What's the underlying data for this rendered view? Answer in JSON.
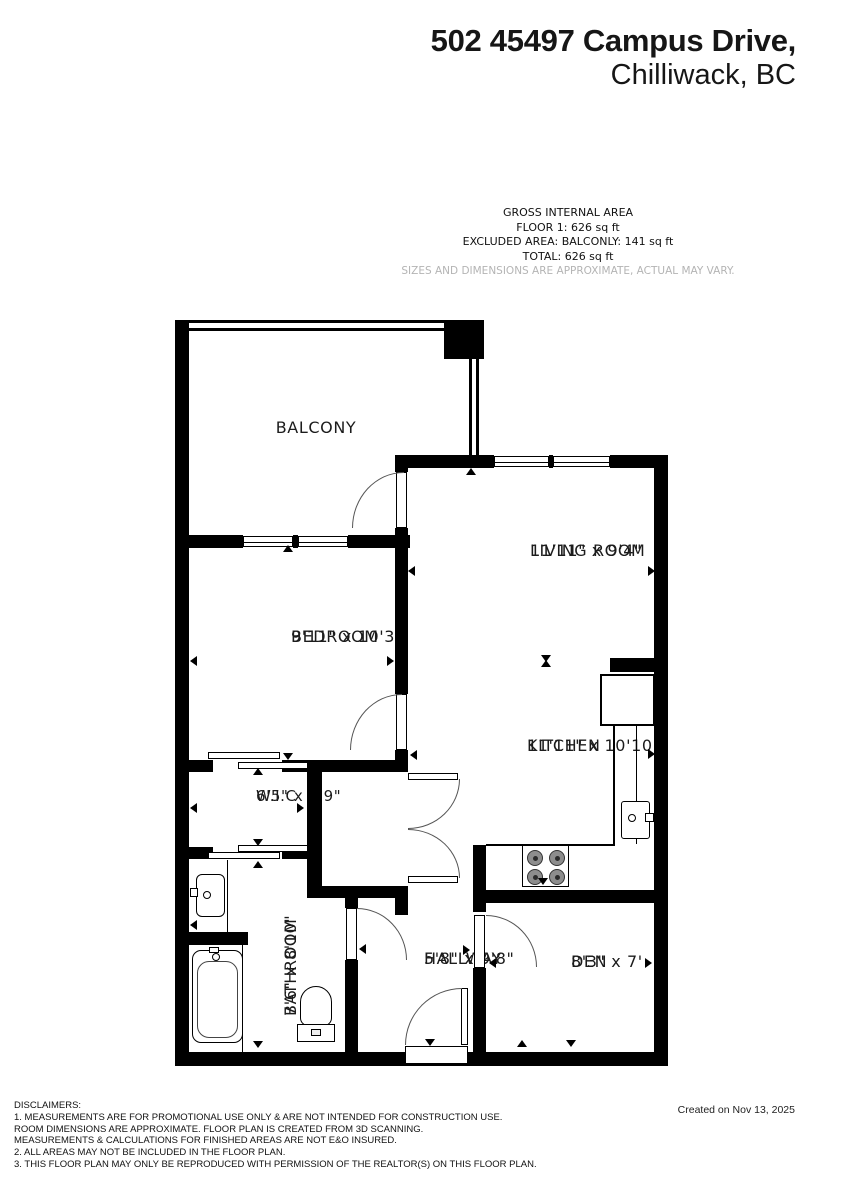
{
  "header": {
    "title_line1": "502 45497 Campus Drive,",
    "title_line2": "Chilliwack, BC"
  },
  "area_summary": {
    "line1": "GROSS INTERNAL AREA",
    "line2": "FLOOR 1: 626 sq ft",
    "line3": "EXCLUDED AREA: BALCONLY: 141 sq ft",
    "line4": "TOTAL: 626 sq ft",
    "note": "SIZES AND DIMENSIONS ARE APPROXIMATE, ACTUAL MAY VARY."
  },
  "rooms": {
    "balcony": {
      "name": "BALCONY",
      "dims": ""
    },
    "living": {
      "name": "LIVING ROOM",
      "dims": "11'11\" x 9'4\""
    },
    "bedroom": {
      "name": "BEDROOM",
      "dims": "9'11\" x 10'3\""
    },
    "kitchen": {
      "name": "KITCHEN",
      "dims": "11'11\" x 10'10\""
    },
    "wic": {
      "name": "W.I.C",
      "dims": "6'5\" x 3'9\""
    },
    "bathroom": {
      "name": "BATHROOM",
      "dims": "7'6\" x 8'10\""
    },
    "hallway": {
      "name": "HALLWAY",
      "dims": "5'8\" x 9'8\""
    },
    "den": {
      "name": "DEN",
      "dims": "8'3\" x 7'"
    }
  },
  "footer": {
    "disclaimers": [
      "DISCLAIMERS:",
      "1. MEASUREMENTS ARE FOR PROMOTIONAL USE ONLY & ARE NOT INTENDED FOR CONSTRUCTION USE.",
      "ROOM DIMENSIONS ARE APPROXIMATE. FLOOR PLAN IS CREATED FROM 3D SCANNING.",
      "MEASUREMENTS & CALCULATIONS FOR FINISHED AREAS ARE NOT E&O INSURED.",
      "2. ALL AREAS MAY NOT BE INCLUDED IN THE FLOOR PLAN.",
      "3. THIS FLOOR PLAN MAY ONLY BE REPRODUCED WITH PERMISSION OF THE REALTOR(S) ON THIS FLOOR PLAN."
    ],
    "created": "Created on Nov 13, 2025"
  },
  "colors": {
    "wall": "#000000",
    "text": "#1b1b1b",
    "muted_note": "#b4b4b4"
  }
}
